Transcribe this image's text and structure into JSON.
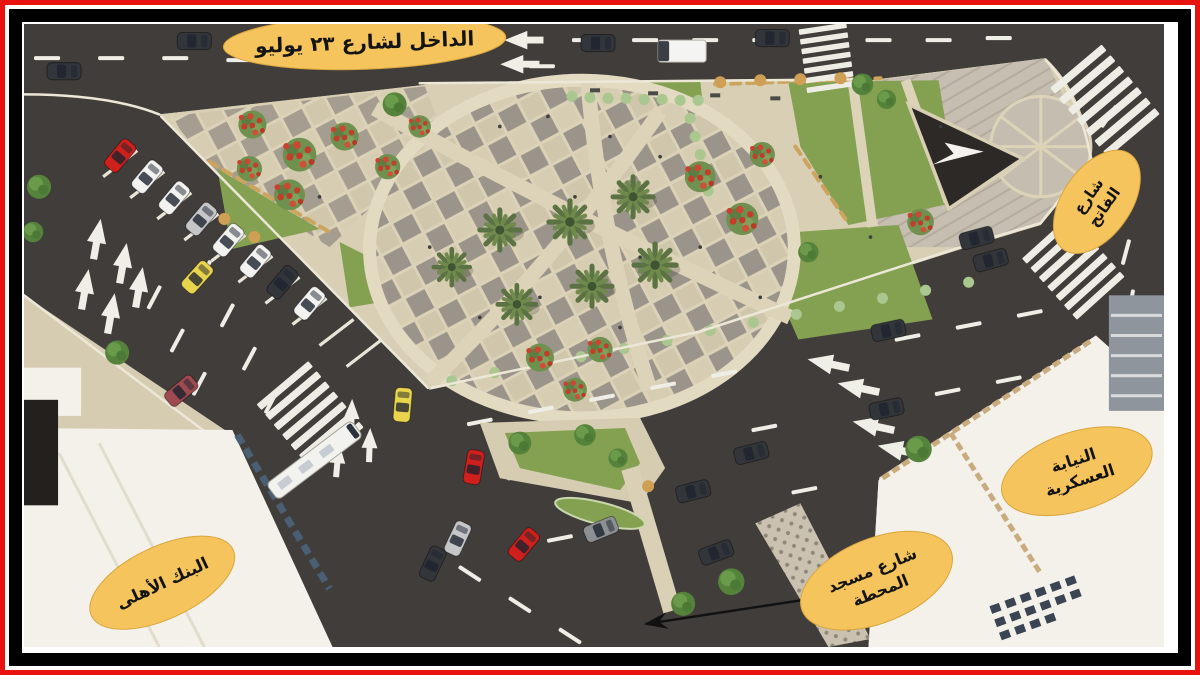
{
  "annotations": {
    "july23_entrance": {
      "text": "الداخل لشارع ٢٣ يوليو"
    },
    "fateh_street": {
      "line1": "شارع",
      "line2": "الفاتح"
    },
    "military_prosecution": {
      "line1": "النيابة",
      "line2": "العسكرية"
    },
    "station_mosque_street": {
      "line1": "شارع مسجد",
      "line2": "المحطة"
    },
    "national_bank": {
      "text": "البنك الأهلى"
    }
  },
  "colors": {
    "frame_outer": "#e8120e",
    "frame_inner": "#000000",
    "matte": "#ffffff",
    "label_fill": "#f6c45c",
    "label_text": "#141414",
    "road": "#413d3a",
    "sidewalk": "#d6ccb2",
    "plaza_tile_light": "#dcd2b8",
    "plaza_tile_dark": "#9b948a",
    "grass": "#83a150",
    "hedge": "#a9c78f",
    "flowers": "#c33d2b",
    "palm": "#5b7342",
    "building": "#f4f1ea",
    "monument": "#2c2927",
    "marking": "#efeee6"
  }
}
